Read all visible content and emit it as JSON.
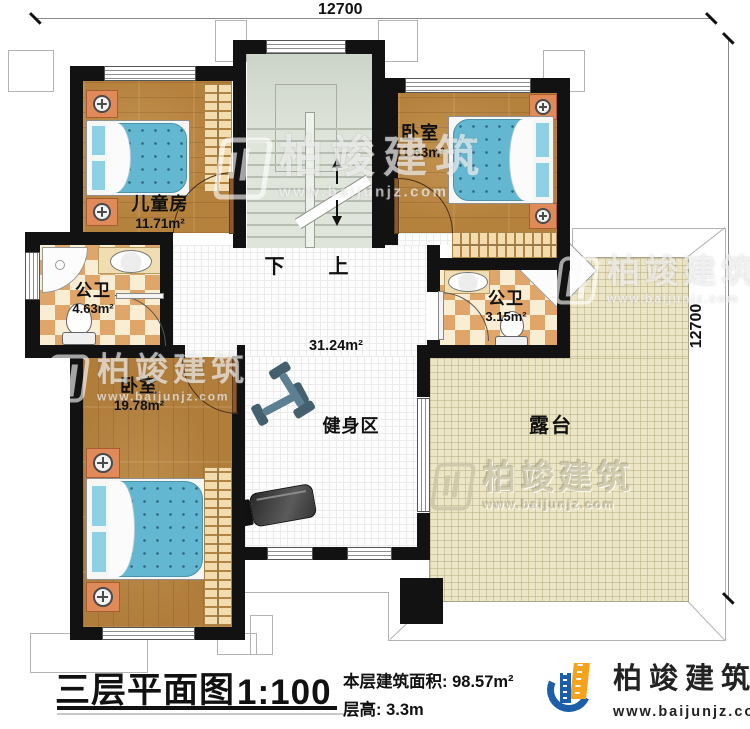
{
  "title": {
    "main": "三层平面图",
    "scale": "1:100",
    "area_label": "本层建筑面积:",
    "area_value": "98.57m²",
    "floor_height_label": "层高:",
    "floor_height_value": "3.3m"
  },
  "brand": {
    "name": "柏竣建筑",
    "site": "www.baijunjz.com"
  },
  "dimensions": {
    "top": "12700",
    "right": "12700"
  },
  "rooms": {
    "kids": {
      "name": "儿童房",
      "area": "11.71m²"
    },
    "bedroom_top": {
      "name": "卧室",
      "area": "11.63m²"
    },
    "bath_left": {
      "name": "公卫",
      "area": "4.63m²"
    },
    "bath_right": {
      "name": "公卫",
      "area": "3.15m²"
    },
    "bedroom_bottom": {
      "name": "卧室",
      "area": "19.78m²"
    },
    "gym": {
      "name": "健身区",
      "area": "31.24m²"
    },
    "terrace": {
      "name": "露台"
    }
  },
  "stairs": {
    "down": "下",
    "up": "上"
  },
  "colors": {
    "wall": "#121212",
    "wood": "#b5823e",
    "bed_blue": "#64b7d1",
    "bath_checker": "#e0a568",
    "terrace": "#ece5c6",
    "stairs": "#dde3d8",
    "brand_blue": "#1c5fa8",
    "brand_orange": "#f6a21d"
  }
}
